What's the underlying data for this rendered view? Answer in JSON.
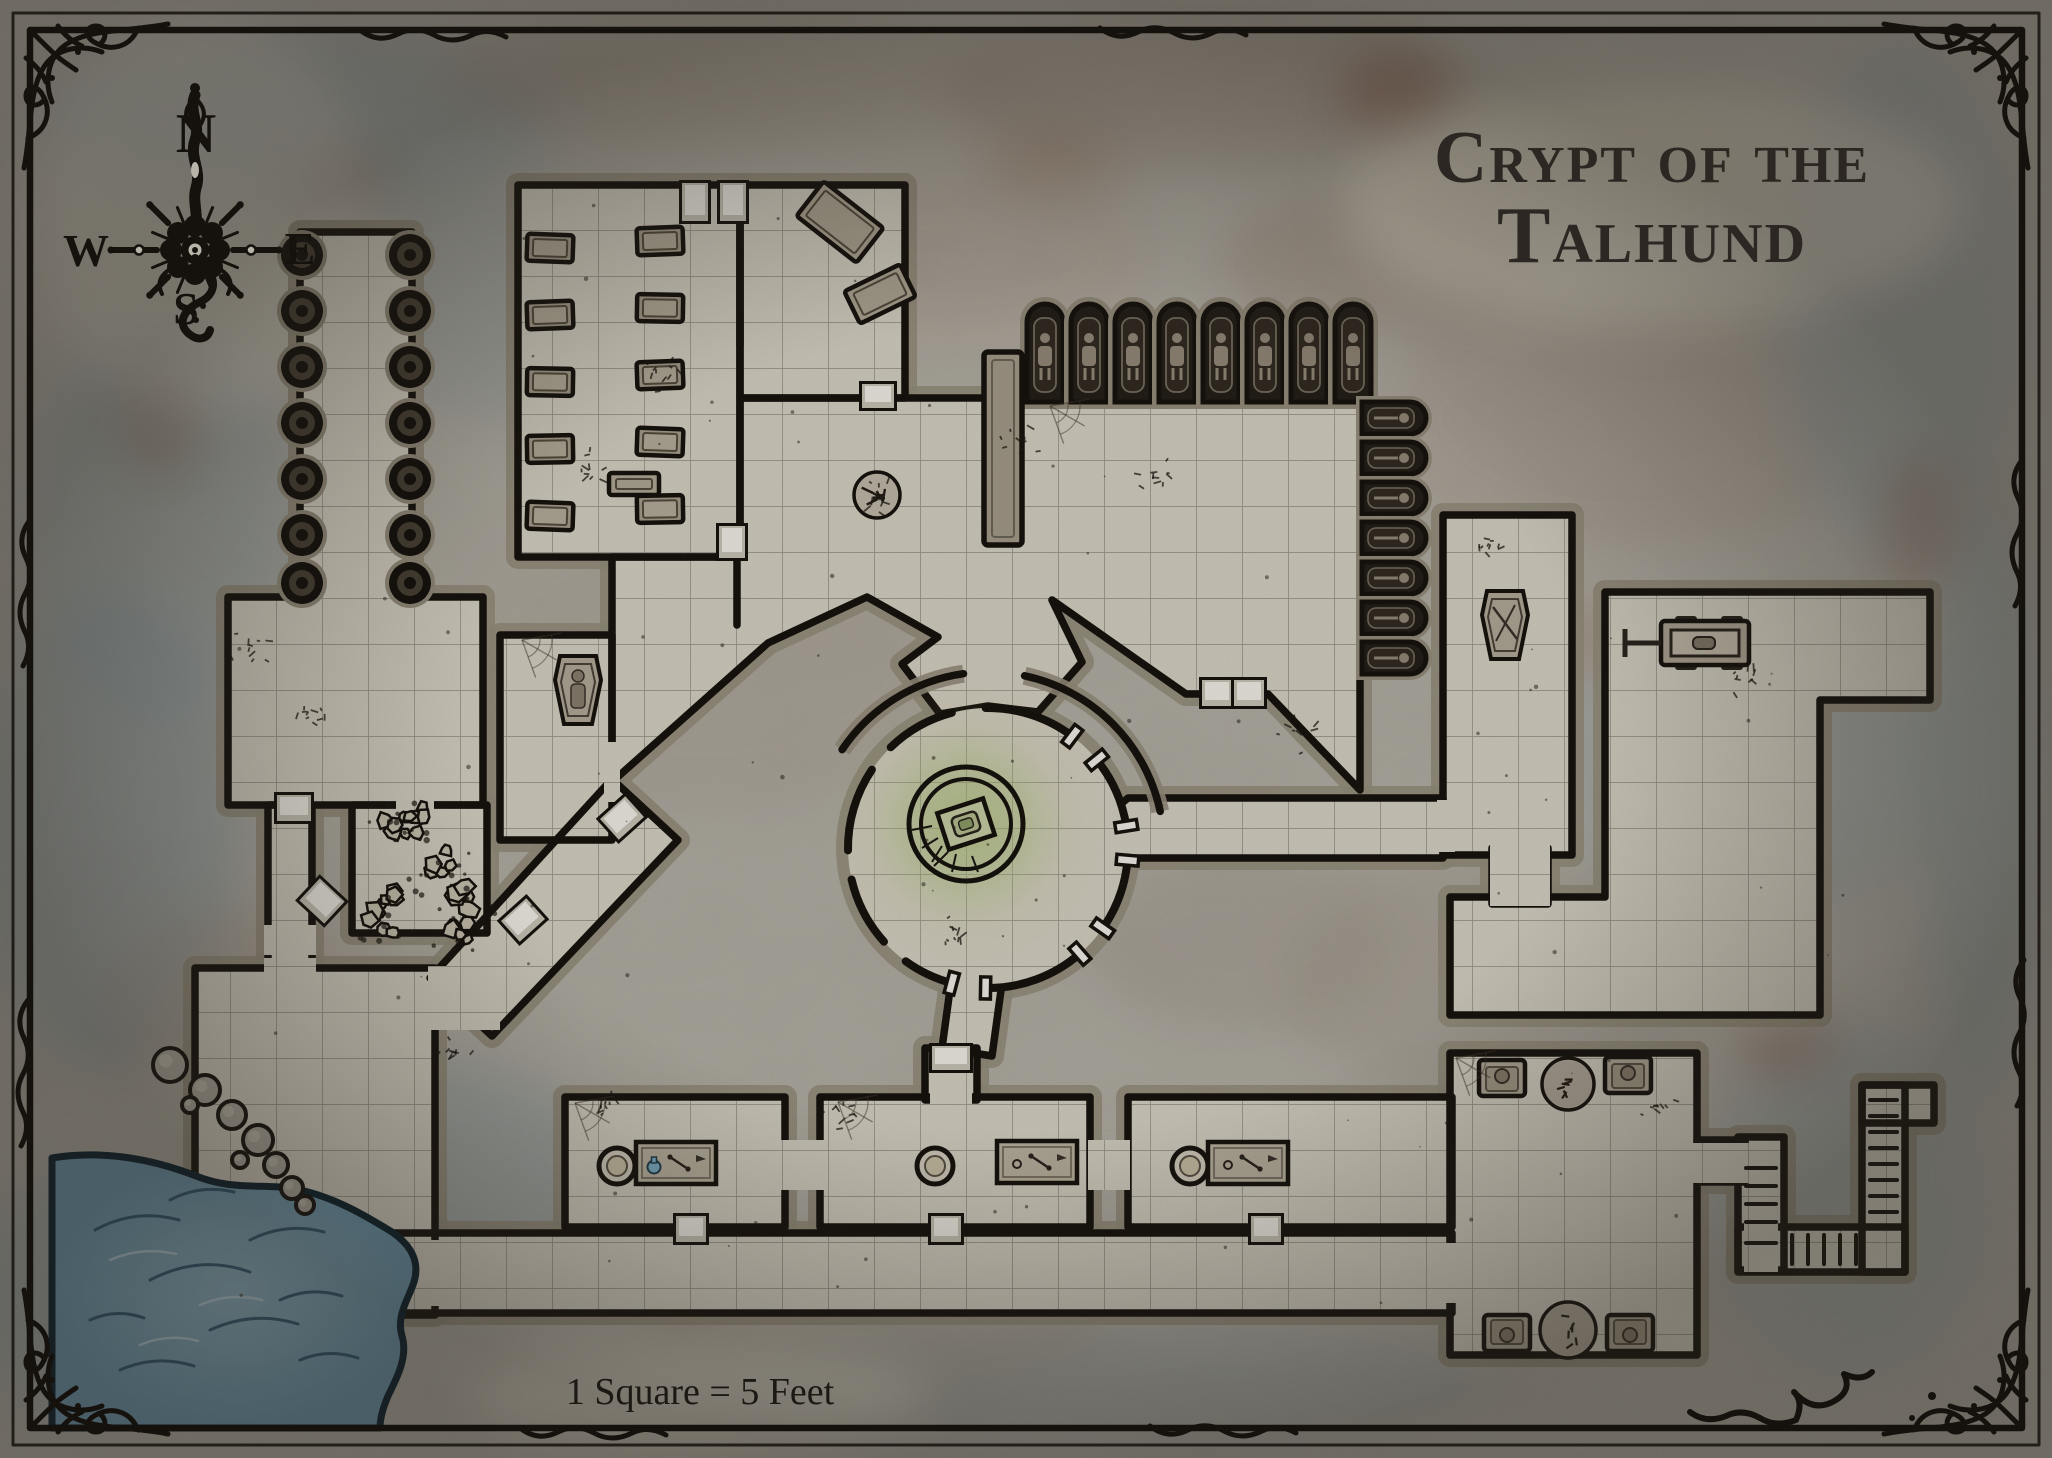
{
  "title": {
    "line1": "Crypt of the",
    "line2": "Talhund"
  },
  "scale_label": "1 Square = 5 Feet",
  "compass": {
    "north": "N",
    "east": "E",
    "south": "S",
    "west": "W"
  },
  "palette": {
    "bg": "#b8b4aa",
    "floor": "#dcd6c8",
    "grid": "#6f6a60",
    "wall": "#18130e",
    "bevel": "#99917f",
    "niche_dark": "#262019",
    "door_face": "#f7f4ec",
    "water": "#7fa9bf",
    "water_line": "#0d2430",
    "glow": "#a6be6e",
    "stone_item": "#b6ad9c",
    "ink": "#15110d"
  },
  "grid": {
    "size": 46
  },
  "background": {
    "blotches": [
      [
        300,
        120,
        260,
        90,
        "#9aa8ac",
        0.5
      ],
      [
        730,
        80,
        300,
        70,
        "#a59a8c",
        0.45
      ],
      [
        1200,
        90,
        260,
        80,
        "#9b8c80",
        0.4
      ],
      [
        520,
        300,
        200,
        120,
        "#9aa6a8",
        0.35
      ],
      [
        160,
        520,
        140,
        200,
        "#9aa8ac",
        0.45
      ],
      [
        110,
        830,
        130,
        240,
        "#93a3a8",
        0.5
      ],
      [
        1620,
        420,
        240,
        140,
        "#a8988a",
        0.35
      ],
      [
        1900,
        300,
        120,
        260,
        "#9aa6a8",
        0.45
      ],
      [
        1750,
        760,
        200,
        160,
        "#95a3a6",
        0.4
      ],
      [
        1500,
        980,
        220,
        120,
        "#9f9488",
        0.35
      ],
      [
        700,
        650,
        260,
        160,
        "#a89d90",
        0.3
      ],
      [
        420,
        1180,
        200,
        120,
        "#8fa0a6",
        0.4
      ],
      [
        1100,
        1380,
        400,
        60,
        "#9aa4a4",
        0.4
      ],
      [
        1850,
        1200,
        140,
        180,
        "#98a5a8",
        0.4
      ],
      [
        960,
        260,
        200,
        90,
        "#ad9d8f",
        0.35
      ],
      [
        1380,
        260,
        160,
        70,
        "#a08b7c",
        0.4
      ],
      [
        240,
        1000,
        140,
        90,
        "#aa9a8a",
        0.35
      ],
      [
        1560,
        160,
        200,
        80,
        "#b0a492",
        0.4
      ],
      [
        60,
        1300,
        80,
        120,
        "#8fa0a6",
        0.45
      ],
      [
        1980,
        800,
        60,
        300,
        "#8fa0a6",
        0.4
      ],
      [
        870,
        1320,
        240,
        70,
        "#a79c8e",
        0.35
      ],
      [
        1240,
        940,
        160,
        90,
        "#9b9184",
        0.3
      ],
      [
        1395,
        90,
        60,
        40,
        "#8a5f4e",
        0.5
      ],
      [
        1788,
        1048,
        50,
        30,
        "#8a5f4e",
        0.4
      ],
      [
        340,
        180,
        40,
        26,
        "#8a5f4e",
        0.4
      ],
      [
        1560,
        640,
        60,
        36,
        "#96705c",
        0.35
      ],
      [
        680,
        1280,
        50,
        30,
        "#8a6a57",
        0.3
      ],
      [
        1050,
        160,
        70,
        40,
        "#9b7a64",
        0.35
      ],
      [
        160,
        420,
        40,
        60,
        "#8a6a57",
        0.35
      ],
      [
        1920,
        520,
        40,
        70,
        "#8a5f4e",
        0.3
      ],
      [
        1652,
        205,
        310,
        120,
        "#ebe4d2",
        0.5
      ],
      [
        700,
        1395,
        230,
        50,
        "#e8e2d2",
        0.5
      ],
      [
        200,
        215,
        170,
        200,
        "#dcd8ca",
        0.45
      ]
    ]
  },
  "map": {
    "floors": [
      {
        "name": "pillar-hall",
        "rect": [
          300,
          232,
          112,
          368
        ]
      },
      {
        "name": "nw-crypt-left",
        "rect": [
          518,
          185,
          222,
          372
        ]
      },
      {
        "name": "nw-crypt-right",
        "rect": [
          740,
          185,
          165,
          213
        ]
      },
      {
        "name": "west-room",
        "rect": [
          228,
          597,
          255,
          208
        ]
      },
      {
        "name": "mummy-room",
        "rect": [
          500,
          635,
          112,
          205
        ]
      },
      {
        "name": "rubble-room",
        "rect": [
          352,
          805,
          135,
          128
        ]
      },
      {
        "name": "west-corridor",
        "rect": [
          268,
          805,
          44,
          200
        ]
      },
      {
        "name": "shore-floor",
        "rect": [
          195,
          968,
          240,
          347
        ]
      },
      {
        "name": "diagonal-corridor",
        "poly": [
          [
            612,
            779
          ],
          [
            678,
            840
          ],
          [
            492,
            1036
          ],
          [
            430,
            978
          ]
        ]
      },
      {
        "name": "plaza-hall",
        "poly": [
          [
            612,
            557
          ],
          [
            740,
            557
          ],
          [
            740,
            398
          ],
          [
            1360,
            398
          ],
          [
            1360,
            790
          ],
          [
            1268,
            694
          ],
          [
            1210,
            694
          ],
          [
            1186,
            694
          ],
          [
            1052,
            600
          ],
          [
            1082,
            662
          ],
          [
            1038,
            712
          ],
          [
            988,
            706
          ],
          [
            940,
            714
          ],
          [
            902,
            664
          ],
          [
            938,
            637
          ],
          [
            867,
            597
          ],
          [
            768,
            643
          ],
          [
            612,
            782
          ],
          [
            612,
            643
          ]
        ]
      },
      {
        "name": "east-passage",
        "poly": [
          [
            1128,
            798
          ],
          [
            1443,
            798
          ],
          [
            1443,
            858
          ],
          [
            1128,
            858
          ],
          [
            1092,
            828
          ]
        ]
      },
      {
        "name": "reliquary-room",
        "rect": [
          1443,
          515,
          129,
          340
        ]
      },
      {
        "name": "east-hall",
        "poly": [
          [
            1605,
            592
          ],
          [
            1930,
            592
          ],
          [
            1930,
            700
          ],
          [
            1820,
            700
          ],
          [
            1820,
            1015
          ],
          [
            1450,
            1015
          ],
          [
            1450,
            897
          ],
          [
            1605,
            897
          ]
        ]
      },
      {
        "name": "link-room",
        "rect": [
          1492,
          848,
          56,
          56
        ]
      },
      {
        "name": "bottom-corridor",
        "rect": [
          390,
          1233,
          1062,
          80
        ]
      },
      {
        "name": "workroom-1",
        "rect": [
          565,
          1097,
          220,
          130
        ]
      },
      {
        "name": "workroom-2",
        "rect": [
          820,
          1097,
          270,
          130
        ]
      },
      {
        "name": "workroom-3",
        "rect": [
          1128,
          1097,
          324,
          130
        ]
      },
      {
        "name": "altar-alcove",
        "rect": [
          925,
          1048,
          52,
          52
        ]
      },
      {
        "name": "chamber-stub",
        "poly": [
          [
            952,
            975
          ],
          [
            1002,
            983
          ],
          [
            992,
            1056
          ],
          [
            942,
            1048
          ]
        ]
      },
      {
        "name": "bottom-right-room",
        "rect": [
          1450,
          1053,
          247,
          302
        ]
      },
      {
        "name": "stair-link",
        "rect": [
          1697,
          1140,
          48,
          42
        ]
      },
      {
        "name": "stair-run-a",
        "rect": [
          1738,
          1137,
          46,
          133
        ]
      },
      {
        "name": "stair-run-h",
        "rect": [
          1738,
          1227,
          167,
          45
        ]
      },
      {
        "name": "stair-run-b",
        "rect": [
          1862,
          1085,
          43,
          187
        ]
      },
      {
        "name": "stair-top",
        "rect": [
          1862,
          1085,
          72,
          38
        ]
      }
    ],
    "wall_segments": [
      [
        740,
        190,
        740,
        345
      ],
      [
        737,
        560,
        737,
        625
      ]
    ],
    "gaps": [
      [
        316,
        584,
        82,
        26
      ],
      [
        396,
        794,
        38,
        24
      ],
      [
        604,
        742,
        16,
        60
      ],
      [
        264,
        925,
        52,
        30
      ],
      [
        264,
        958,
        52,
        60
      ],
      [
        428,
        966,
        72,
        64
      ],
      [
        386,
        1240,
        60,
        66
      ],
      [
        780,
        1140,
        46,
        50
      ],
      [
        1088,
        1140,
        42,
        50
      ],
      [
        930,
        1086,
        42,
        26
      ],
      [
        1437,
        800,
        18,
        52
      ],
      [
        1490,
        842,
        60,
        64
      ],
      [
        1442,
        1243,
        20,
        60
      ],
      [
        1690,
        1143,
        62,
        40
      ],
      [
        1734,
        1146,
        18,
        34
      ],
      [
        1744,
        1222,
        34,
        50
      ],
      [
        1866,
        1232,
        34,
        36
      ],
      [
        1866,
        1090,
        34,
        28
      ]
    ],
    "doors": [
      [
        682,
        183,
        26,
        38,
        0
      ],
      [
        720,
        183,
        26,
        38,
        0
      ],
      [
        862,
        384,
        32,
        24,
        0
      ],
      [
        719,
        526,
        26,
        32,
        0
      ],
      [
        277,
        795,
        34,
        26,
        0
      ],
      [
        305,
        886,
        34,
        30,
        43
      ],
      [
        605,
        804,
        34,
        28,
        -42
      ],
      [
        506,
        906,
        34,
        28,
        -42
      ],
      [
        1202,
        680,
        30,
        26,
        0
      ],
      [
        1234,
        680,
        30,
        26,
        0
      ],
      [
        932,
        1046,
        38,
        24,
        0
      ],
      [
        676,
        1216,
        30,
        26,
        0
      ],
      [
        931,
        1216,
        30,
        26,
        0
      ],
      [
        1251,
        1216,
        30,
        26,
        0
      ]
    ],
    "pillar_hall": {
      "cx": [
        302,
        410
      ],
      "cy": [
        255,
        311,
        367,
        423,
        479,
        535,
        583
      ],
      "r": 21
    },
    "long_pillar": [
      984,
      352,
      38,
      193
    ],
    "statue_niches": {
      "x0": 1045,
      "step": 44,
      "count": 8,
      "top": 304,
      "base": 402,
      "w": 36
    },
    "coffin_niches": {
      "x": 1362,
      "y0": 418,
      "step": 40,
      "count": 7,
      "w": 64,
      "h": 32
    },
    "nw_coffins": [
      [
        550,
        248,
        2
      ],
      [
        550,
        315,
        -2
      ],
      [
        550,
        382,
        1
      ],
      [
        550,
        449,
        -1
      ],
      [
        550,
        516,
        2
      ],
      [
        660,
        241,
        -2
      ],
      [
        660,
        308,
        1
      ],
      [
        660,
        375,
        -2
      ],
      [
        660,
        442,
        2
      ],
      [
        660,
        509,
        -1
      ]
    ],
    "coffin_size": [
      46,
      27
    ],
    "tilted_slabs": [
      [
        840,
        222,
        76,
        44,
        38
      ],
      [
        880,
        294,
        62,
        36,
        -26
      ],
      [
        634,
        484,
        50,
        22,
        0
      ]
    ],
    "sarcophagi": [
      {
        "cx": 578,
        "cy": 690,
        "figure": true
      },
      {
        "cx": 1505,
        "cy": 625,
        "figure": false
      }
    ],
    "chamber": {
      "cx": 988,
      "cy": 848,
      "r": 140,
      "ring1": 57,
      "ring2": 45,
      "altar": {
        "cx": 966,
        "cy": 824,
        "w": 48,
        "h": 38,
        "rot": -18
      },
      "gaps": [
        {
          "a": 2,
          "w": 7,
          "j": true
        },
        {
          "a": 46,
          "w": 7,
          "j": true
        },
        {
          "a": 98,
          "w": 7,
          "j": false
        },
        {
          "a": 140,
          "w": 6,
          "j": false
        },
        {
          "a": 187,
          "w": 6,
          "j": false
        },
        {
          "a": 228,
          "w": 6,
          "j": false
        },
        {
          "a": 262,
          "w": 7,
          "j": true
        },
        {
          "a": 318,
          "w": 7,
          "j": true
        }
      ],
      "outer_arcs": [
        [
          12,
          78
        ],
        [
          98,
          146
        ]
      ],
      "outer_r": 176
    },
    "workbenches": [
      {
        "basin": [
          617,
          1166
        ],
        "table": [
          676,
          1163
        ],
        "flask": true
      },
      {
        "basin": [
          935,
          1166
        ],
        "table": [
          1037,
          1162
        ],
        "flask": false
      },
      {
        "basin": [
          1190,
          1166
        ],
        "table": [
          1248,
          1163
        ],
        "flask": false
      }
    ],
    "cart": [
      1705,
      643
    ],
    "br_room": {
      "alcoves": [
        [
          1502,
          1078,
          0
        ],
        [
          1628,
          1075,
          0
        ],
        [
          1507,
          1333,
          180
        ],
        [
          1630,
          1333,
          180
        ]
      ],
      "debris": [
        [
          1568,
          1084,
          26
        ],
        [
          1568,
          1330,
          28
        ]
      ]
    },
    "stair_treads": [
      {
        "dir": "v",
        "rect": [
          1738,
          1137,
          46,
          133
        ],
        "pos": [
          1168,
          1186,
          1204,
          1222,
          1243
        ]
      },
      {
        "dir": "h",
        "rect": [
          1738,
          1227,
          167,
          45
        ],
        "pos": [
          1792,
          1808,
          1824,
          1840,
          1856
        ]
      },
      {
        "dir": "v",
        "rect": [
          1862,
          1085,
          43,
          187
        ],
        "pos": [
          1100,
          1116,
          1132,
          1148,
          1164,
          1180,
          1196,
          1212
        ]
      }
    ],
    "rubble_piles": [
      [
        388,
        824
      ],
      [
        448,
        858
      ],
      [
        398,
        894
      ],
      [
        452,
        930
      ],
      [
        420,
        822
      ],
      [
        470,
        898
      ],
      [
        385,
        922
      ]
    ],
    "debris_spots": [
      [
        877,
        495
      ],
      [
        662,
        372
      ],
      [
        1155,
        478
      ],
      [
        588,
        468
      ],
      [
        1020,
        440
      ],
      [
        1300,
        735
      ],
      [
        305,
        712
      ],
      [
        835,
        1108
      ],
      [
        1660,
        1108
      ],
      [
        600,
        1110
      ],
      [
        250,
        650
      ],
      [
        1485,
        545
      ],
      [
        1740,
        680
      ],
      [
        958,
        930
      ],
      [
        452,
        1056
      ]
    ],
    "bone_pile": [
      877,
      495
    ],
    "webs": [
      [
        575,
        1103
      ],
      [
        1050,
        406
      ],
      [
        838,
        1102
      ],
      [
        1456,
        1058
      ],
      [
        522,
        640
      ]
    ],
    "water": {
      "path": "M52,1158 C100,1150 150,1158 196,1176 C236,1192 266,1182 300,1190 C336,1198 366,1216 392,1232 C412,1246 420,1262 414,1282 C408,1300 396,1316 402,1336 C408,1356 398,1376 388,1396 C382,1410 380,1420 380,1428 L52,1428 Z",
      "waves": [
        "M95,1230 q40,-22 84,-10",
        "M150,1280 q50,-26 100,-8",
        "M210,1330 q44,-20 88,-6",
        "M120,1370 q36,-16 74,-4",
        "M250,1240 q36,-18 74,-8",
        "M280,1300 q30,-14 62,-4",
        "M90,1320 q26,-12 54,-2",
        "M300,1360 q28,-12 58,-2",
        "M170,1200 q30,-16 64,-8"
      ],
      "light_waves": [
        "M110,1260 q32,-14 66,-6",
        "M200,1305 q30,-13 62,-5",
        "M140,1345 q28,-12 58,-4"
      ]
    },
    "rocks": [
      [
        170,
        1065,
        17
      ],
      [
        205,
        1090,
        15
      ],
      [
        232,
        1115,
        14
      ],
      [
        258,
        1140,
        15
      ],
      [
        276,
        1165,
        12
      ],
      [
        292,
        1188,
        11
      ],
      [
        190,
        1105,
        8
      ],
      [
        240,
        1160,
        8
      ],
      [
        305,
        1205,
        9
      ]
    ]
  },
  "frame": {
    "inset_outer": 13,
    "inset_main": 30
  }
}
